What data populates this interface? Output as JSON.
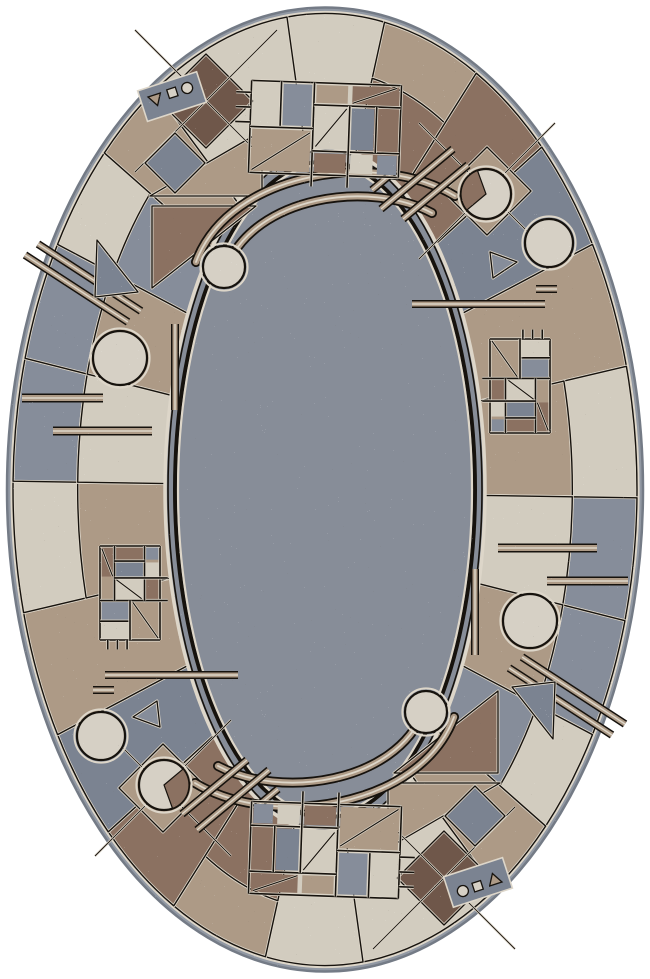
{
  "meta": {
    "description": "Oval tufted area rug with Bauhaus-style geometric patchwork border (gray, cream, tan, brown segments with circles, triangles, diamonds, grid motifs and parallel line accents) around a speckled gray-blue field, photographed flat on a white background",
    "symmetry": "180-degree rotational symmetry about the rug center"
  },
  "canvas": {
    "width": 650,
    "height": 979
  },
  "palette": {
    "background": "#ffffff",
    "edge": "#9299a4",
    "edgeDark": "#747b86",
    "cream": "#d2ccbf",
    "creamLine": "#ddd6c9",
    "tan": "#ad9a86",
    "tanLight": "#c1b3a0",
    "brown": "#8b7161",
    "darkBrown": "#6f574a",
    "gray": "#868d9a",
    "grayDark": "#7b8391",
    "field": "#878d98",
    "outline": "#16120d",
    "circleFill": "#d6d0c5",
    "speckLight": "#f2f3f5",
    "speckDark": "#2e2a26"
  },
  "geometry": {
    "cx": 325,
    "cy": 489.5,
    "edge": {
      "rx": 318,
      "ry": 482
    },
    "borderOuter": {
      "rx": 312,
      "ry": 476
    },
    "borderInner": {
      "rx": 158,
      "ry": 340
    },
    "splitFraction": 0.42,
    "field": {
      "rx": 160,
      "ry": 342
    },
    "innerOval": {
      "rx": 150,
      "ry": 328
    },
    "halfSweep": [
      -97,
      83
    ]
  },
  "border_segments": [
    {
      "from": -97,
      "to": -79,
      "outer": "cream",
      "inner": "cream"
    },
    {
      "from": -79,
      "to": -61,
      "outer": "tan",
      "inner": "brown"
    },
    {
      "from": -61,
      "to": -46,
      "outer": "brown",
      "inner": "brown"
    },
    {
      "from": -46,
      "to": -31,
      "outer": "grayDark",
      "inner": "grayDark"
    },
    {
      "from": -31,
      "to": -15,
      "outer": "tan",
      "inner": "tan"
    },
    {
      "from": -15,
      "to": 1,
      "outer": "cream",
      "inner": "tan"
    },
    {
      "from": 1,
      "to": 16,
      "outer": "gray",
      "inner": "cream"
    },
    {
      "from": 16,
      "to": 31,
      "outer": "gray",
      "inner": "tan"
    },
    {
      "from": 31,
      "to": 45,
      "outer": "cream",
      "inner": "gray"
    },
    {
      "from": 45,
      "to": 57,
      "outer": "tan",
      "inner": "tan"
    },
    {
      "from": 57,
      "to": 83,
      "outer": "cream",
      "inner": "cream"
    }
  ],
  "pattern_grid": {
    "unitWidth": 100,
    "unitHeight": 62,
    "lines": [
      [
        0,
        0,
        100,
        0
      ],
      [
        0,
        62,
        100,
        62
      ],
      [
        0,
        0,
        0,
        62
      ],
      [
        100,
        0,
        100,
        62
      ],
      [
        42,
        0,
        42,
        62
      ],
      [
        20,
        0,
        20,
        31
      ],
      [
        0,
        31,
        42,
        31
      ],
      [
        42,
        15,
        100,
        15
      ],
      [
        42,
        46,
        100,
        46
      ],
      [
        66,
        15,
        66,
        62
      ],
      [
        84,
        15,
        84,
        46
      ],
      [
        -10,
        8,
        0,
        8
      ],
      [
        -10,
        18,
        0,
        18
      ],
      [
        -10,
        28,
        0,
        28
      ],
      [
        42,
        62,
        42,
        70
      ],
      [
        66,
        62,
        66,
        70
      ]
    ],
    "cells": [
      [
        1.5,
        1.5,
        17,
        28,
        "cream"
      ],
      [
        21.5,
        1.5,
        19,
        28,
        "gray"
      ],
      [
        1.5,
        32.5,
        39,
        28,
        "tan"
      ],
      [
        43.5,
        1.5,
        21,
        12,
        "tan"
      ],
      [
        67.5,
        1.5,
        31,
        12,
        "brown"
      ],
      [
        43.5,
        16.5,
        21,
        28,
        "cream"
      ],
      [
        67.5,
        16.5,
        15,
        28,
        "grayDark"
      ],
      [
        85.5,
        16.5,
        13,
        28,
        "brown"
      ],
      [
        43.5,
        47.5,
        21,
        13,
        "brown"
      ],
      [
        67.5,
        47.5,
        15,
        13,
        "cream"
      ],
      [
        85.5,
        47.5,
        13,
        13,
        "gray"
      ]
    ],
    "diagonals": [
      [
        2,
        60,
        40,
        34
      ],
      [
        44,
        43,
        64,
        17
      ],
      [
        68,
        13,
        97,
        2
      ]
    ]
  },
  "trio": {
    "tri": 13,
    "sq": 9,
    "r": 5.5,
    "bg": [
      -8,
      -9,
      62,
      32
    ]
  },
  "motifs": [
    {
      "type": "tripatch",
      "name": "tan-triangle-patch",
      "pts": [
        [
          150,
          196
        ],
        [
          262,
          196
        ],
        [
          262,
          131
        ]
      ],
      "fill": "tan"
    },
    {
      "type": "tripatch",
      "name": "brown-triangle-patch",
      "pts": [
        [
          152,
          288
        ],
        [
          152,
          206
        ],
        [
          256,
          206
        ]
      ],
      "fill": "brown"
    },
    {
      "type": "diamond",
      "name": "diamond-checker-large",
      "cx": 206,
      "cy": 101,
      "r": 47,
      "fill": "darkBrown",
      "lattice": true
    },
    {
      "type": "diamond",
      "name": "diamond-small",
      "cx": 175,
      "cy": 163,
      "r": 30,
      "fill": "grayDark"
    },
    {
      "type": "diamond",
      "name": "diamond-tan",
      "cx": 487,
      "cy": 191,
      "r": 44,
      "fill": "tan",
      "lattice": true
    },
    {
      "type": "swoosh",
      "name": "swoosh-arc-outer",
      "d": "M196,262 C230,170 380,150 455,196"
    },
    {
      "type": "swoosh",
      "name": "swoosh-arc-inner",
      "d": "M226,268 C255,195 370,180 432,213"
    },
    {
      "type": "bars",
      "name": "double-diagonal-lines-left",
      "w": 5,
      "lines": [
        [
          25,
          255,
          128,
          322
        ],
        [
          38,
          244,
          141,
          311
        ]
      ]
    },
    {
      "type": "bars",
      "name": "vertical-bar-left",
      "w": 5,
      "lines": [
        [
          175,
          324,
          175,
          410
        ]
      ]
    },
    {
      "type": "bars",
      "name": "horizontal-bars-left",
      "w": 6,
      "lines": [
        [
          22,
          398,
          103,
          398
        ],
        [
          53,
          431,
          152,
          431
        ]
      ]
    },
    {
      "type": "bars",
      "name": "horizontal-bar-right",
      "w": 5,
      "lines": [
        [
          412,
          304,
          545,
          304
        ],
        [
          536,
          289,
          557,
          289
        ]
      ]
    },
    {
      "type": "bars",
      "name": "double-diagonal-lines-top-right",
      "w": 5,
      "lines": [
        [
          381,
          209,
          453,
          149
        ],
        [
          403,
          219,
          468,
          165
        ],
        [
          372,
          190,
          396,
          170
        ]
      ]
    },
    {
      "type": "mondrian",
      "name": "grid-motif-top",
      "cx": 325,
      "cy": 129,
      "w": 150,
      "h": 92,
      "rot": 2
    },
    {
      "type": "mondrian",
      "name": "grid-motif-right",
      "cx": 520,
      "cy": 386,
      "w": 94,
      "h": 60,
      "rot": 90
    },
    {
      "type": "circle",
      "name": "circle-top-right",
      "cx": 549,
      "cy": 243,
      "r": 24
    },
    {
      "type": "circle",
      "name": "circle-left",
      "cx": 120,
      "cy": 358,
      "r": 27
    },
    {
      "type": "circle",
      "name": "circle-swoosh-end",
      "cx": 224,
      "cy": 267,
      "r": 21
    },
    {
      "type": "pacman",
      "name": "circle-with-wedge",
      "cx": 486,
      "cy": 194,
      "r": 25,
      "a0": 140,
      "a1": 250,
      "wedge": "brown"
    },
    {
      "type": "triangle",
      "name": "triangle-outline-left",
      "pts": [
        [
          97,
          240
        ],
        [
          138,
          292
        ],
        [
          95,
          297
        ]
      ],
      "fill": "grayDark"
    },
    {
      "type": "triangle",
      "name": "triangle-small-right",
      "pts": [
        [
          490,
          252
        ],
        [
          517,
          262
        ],
        [
          493,
          278
        ]
      ],
      "fill": "gray"
    },
    {
      "type": "trio",
      "name": "mini-shapes-triangle-square-dot",
      "x": 148,
      "y": 97,
      "rot": -18
    }
  ]
}
